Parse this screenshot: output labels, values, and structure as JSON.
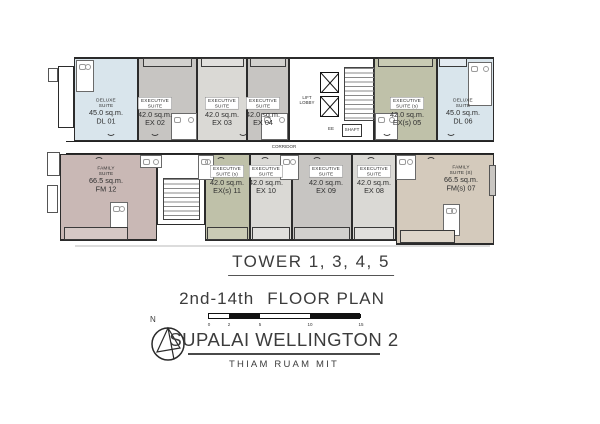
{
  "plan": {
    "corridor_label": "CORRIDOR",
    "lift_lobby": {
      "line1": "LIFT",
      "line2": "LOBBY"
    },
    "ee_label": "EE",
    "shaft_label": "SHAFT",
    "units": [
      {
        "name_line1": "DELUXE",
        "name_line2": "SUITE",
        "area": "45.0 sq.m.",
        "code": "DL 01"
      },
      {
        "name_line1": "EXECUTIVE",
        "name_line2": "SUITE",
        "area": "42.0 sq.m.",
        "code": "EX 02"
      },
      {
        "name_line1": "EXECUTIVE",
        "name_line2": "SUITE",
        "area": "42.0 sq.m.",
        "code": "EX 03"
      },
      {
        "name_line1": "EXECUTIVE",
        "name_line2": "SUITE",
        "area": "42.0 sq.m.",
        "code": "EX 04"
      },
      {
        "name_line1": "EXECUTIVE",
        "name_line2": "SUITE (s)",
        "area": "42.0 sq.m.",
        "code": "EX(s) 05"
      },
      {
        "name_line1": "DELUXE",
        "name_line2": "SUITE",
        "area": "45.0 sq.m.",
        "code": "DL 06"
      },
      {
        "name_line1": "FAMILY",
        "name_line2": "SUITE (S)",
        "area": "66.5 sq.m.",
        "code": "FM(s) 07"
      },
      {
        "name_line1": "EXECUTIVE",
        "name_line2": "SUITE",
        "area": "42.0 sq.m.",
        "code": "EX 08"
      },
      {
        "name_line1": "EXECUTIVE",
        "name_line2": "SUITE",
        "area": "42.0 sq.m.",
        "code": "EX 09"
      },
      {
        "name_line1": "EXECUTIVE",
        "name_line2": "SUITE",
        "area": "42.0 sq.m.",
        "code": "EX 10"
      },
      {
        "name_line1": "EXECUTIVE",
        "name_line2": "SUITE (s)",
        "area": "42.0 sq.m.",
        "code": "EX(s) 11"
      },
      {
        "name_line1": "FAMILY",
        "name_line2": "SUITE",
        "area": "66.5 sq.m.",
        "code": "FM 12"
      }
    ]
  },
  "annotations": {
    "tower_title": "TOWER 1, 3, 4, 5",
    "floor_range": "2nd-14th",
    "floor_plan_label": "FLOOR PLAN",
    "project_title": "SUPALAI WELLINGTON 2",
    "project_subtitle": "THIAM RUAM MIT",
    "compass_label": "N",
    "scalebar": {
      "ticks": [
        "0",
        "2",
        "5",
        "10",
        "15"
      ]
    }
  },
  "colors": {
    "deluxe_blue": "#d9e5ec",
    "executive_gray_dark": "#c7c5c2",
    "executive_gray_light": "#dad9d5",
    "executive_s_olive": "#bfc1a9",
    "family_mauve": "#c9b8b5",
    "family_s_beige": "#d4cabc",
    "wall": "#2b2b2b",
    "text": "#3c3c3c"
  }
}
